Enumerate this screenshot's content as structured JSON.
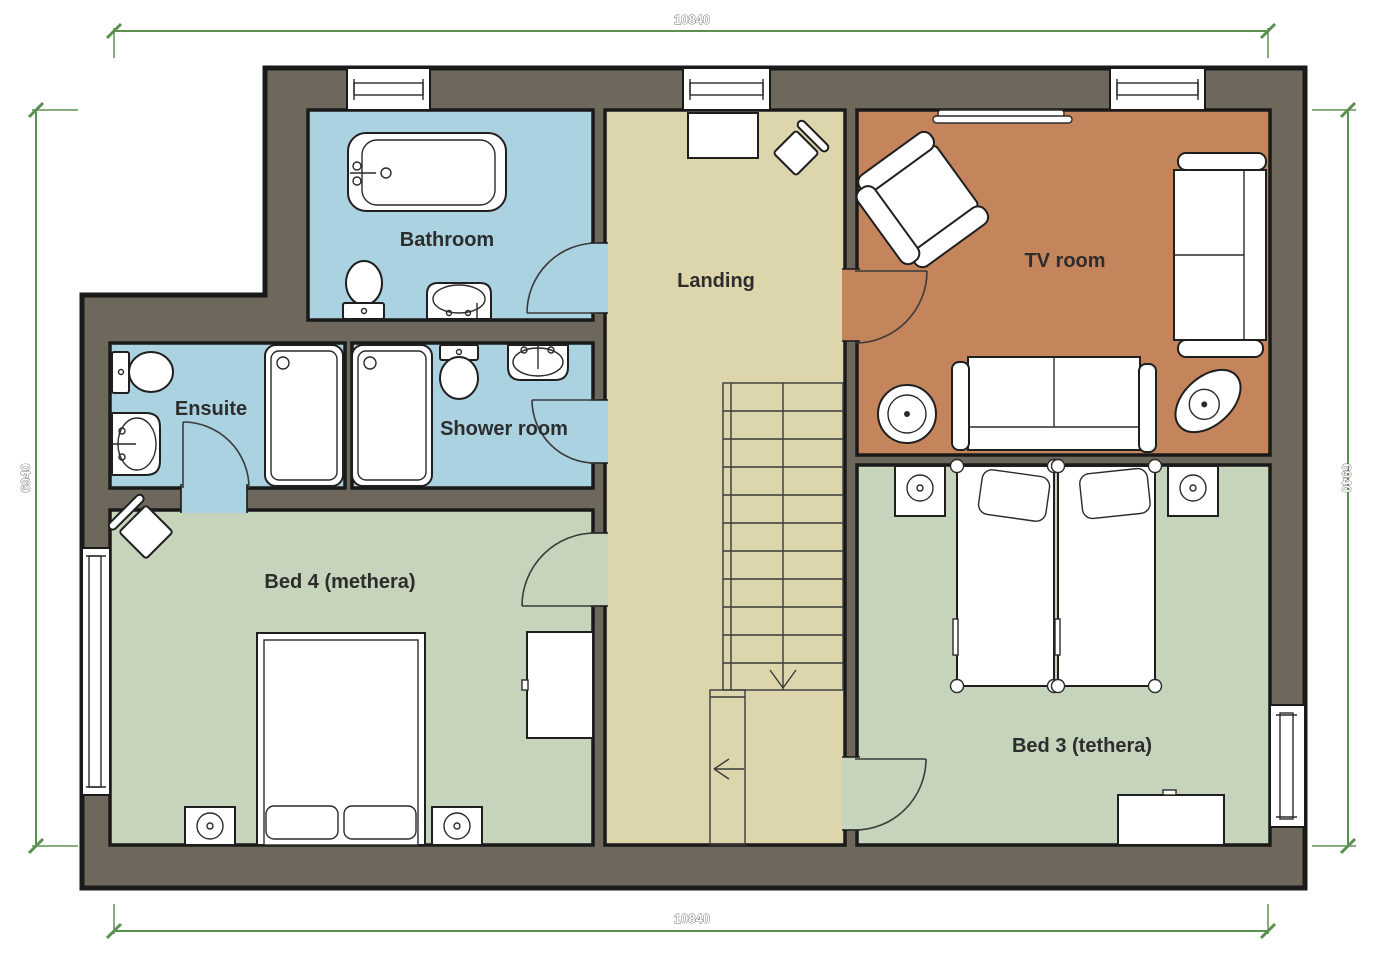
{
  "rooms": {
    "bathroom": {
      "label": "Bathroom"
    },
    "ensuite": {
      "label": "Ensuite"
    },
    "shower_room": {
      "label": "Shower room"
    },
    "landing": {
      "label": "Landing"
    },
    "tv_room": {
      "label": "TV room"
    },
    "bed4": {
      "label": "Bed 4 (methera)"
    },
    "bed3": {
      "label": "Bed 3 (tethera)"
    }
  },
  "dims": {
    "top": "10840",
    "bottom": "10840",
    "left": "6940",
    "right": "6940"
  },
  "colors": {
    "wall": "#6e675b",
    "outline": "#1a1a1a",
    "wet_room": "#abd2e0",
    "landing": "#ddd6ad",
    "tv_room": "#c4845c",
    "bedroom": "#c5d4ba",
    "dimension": "#5b9150",
    "furniture": "#ffffff"
  }
}
